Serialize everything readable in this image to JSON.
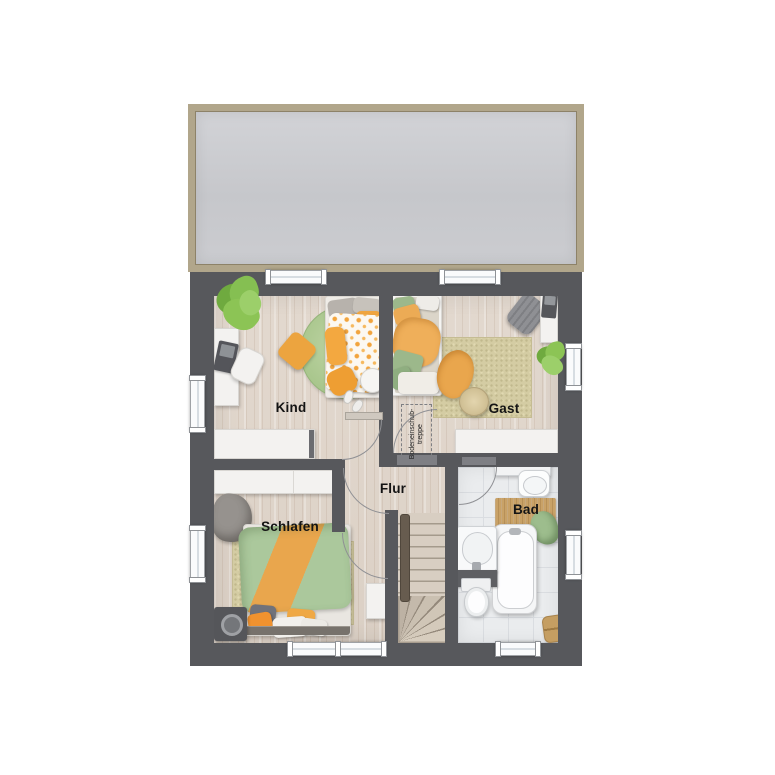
{
  "floor_plan": {
    "rooms": {
      "kind": {
        "label": "Kind"
      },
      "gast": {
        "label": "Gast"
      },
      "flur": {
        "label": "Flur"
      },
      "schlafen": {
        "label": "Schlafen"
      },
      "bad": {
        "label": "Bad"
      }
    },
    "annotations": {
      "attic_hatch": "Bodeneinschub-\ntreppe"
    },
    "colors": {
      "wall": "#57585c",
      "roof_fill": "#c8c9cd",
      "roof_border": "#b1a68b",
      "wood_floor": "#ddd2c8",
      "tile_floor": "#eaecee",
      "rug_beige": "#d4cca3",
      "accent_orange": "#eea74b",
      "accent_green": "#a9c79b",
      "plant_green": "#7fb94d"
    }
  }
}
